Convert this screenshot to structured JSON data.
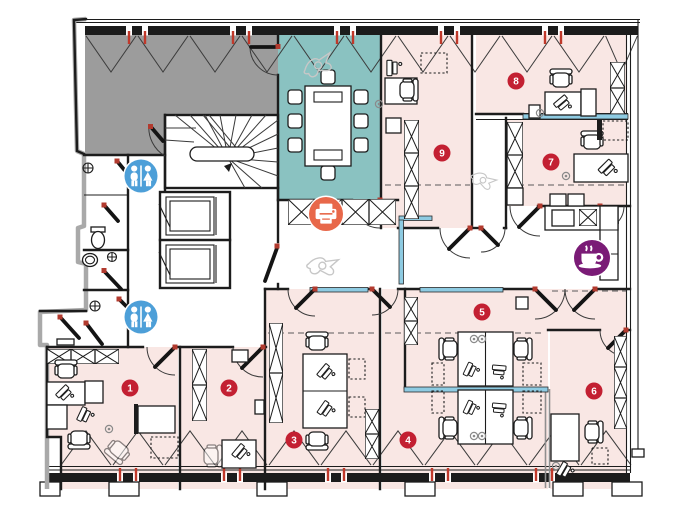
{
  "plan": {
    "rooms": [
      {
        "id": "room-1",
        "number": "1"
      },
      {
        "id": "room-2",
        "number": "2"
      },
      {
        "id": "room-3",
        "number": "3"
      },
      {
        "id": "room-4",
        "number": "4"
      },
      {
        "id": "room-5",
        "number": "5"
      },
      {
        "id": "room-6",
        "number": "6"
      },
      {
        "id": "room-7",
        "number": "7"
      },
      {
        "id": "room-8",
        "number": "8"
      },
      {
        "id": "room-9",
        "number": "9"
      }
    ],
    "amenity_icons": [
      {
        "id": "restroom-upper",
        "type": "restroom-icon"
      },
      {
        "id": "restroom-lower",
        "type": "restroom-icon"
      },
      {
        "id": "printer",
        "type": "printer-icon"
      },
      {
        "id": "coffee",
        "type": "coffee-icon"
      }
    ],
    "zones": [
      {
        "id": "gray-zone",
        "kind": "shaded-unassigned-room"
      },
      {
        "id": "teal-zone",
        "kind": "meeting-room"
      },
      {
        "id": "pink-zones",
        "kind": "office-rooms"
      }
    ]
  },
  "colors": {
    "zone_gray": "#9c9c9c",
    "zone_teal": "#8ac2c1",
    "zone_pink": "#f9e7e4",
    "glass_blue": "#8ecbe2",
    "badge_red": "#c32032",
    "icon_blue": "#4d9fd8",
    "icon_orange": "#e8684a",
    "icon_purple": "#7a1b76",
    "window_tick_red": "#c0392b",
    "wall_black": "#1c1c1c"
  }
}
